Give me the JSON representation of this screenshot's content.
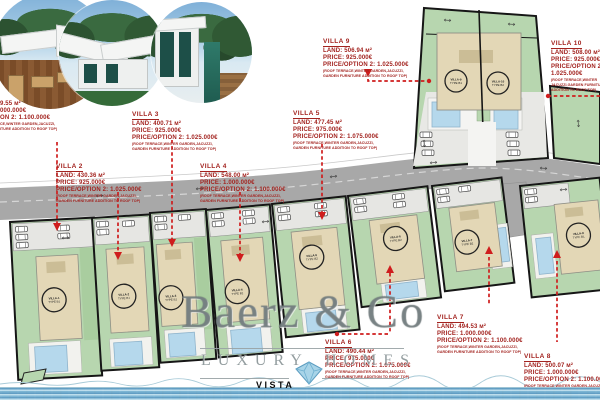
{
  "colors": {
    "annotation_red": "#a32420",
    "leader_red": "#cf1d1d",
    "plot_green": "#b7d6af",
    "building_beige": "#e3d7b6",
    "roof_beige": "#cbbd96",
    "pool_blue": "#b5d8ec",
    "road_gray": "#a8a8a8",
    "water_blue": "#7db8d6"
  },
  "watermark": {
    "brand": "Baerz & Co",
    "word_left": "LUXURY",
    "word_right": "HOMES",
    "footer": "VISTA"
  },
  "plan": {
    "units": [
      {
        "name": "VILLA-1",
        "type": "TYPE B1"
      },
      {
        "name": "VILLA-2",
        "type": "TYPE B1"
      },
      {
        "name": "VILLA-3",
        "type": "TYPE B1"
      },
      {
        "name": "VILLA-4",
        "type": "TYPE B1"
      },
      {
        "name": "VILLA-5",
        "type": "TYPE B2"
      },
      {
        "name": "VILLA-6",
        "type": "TYPE B2"
      },
      {
        "name": "VILLA-7",
        "type": "TYPE B2"
      },
      {
        "name": "VILLA-8",
        "type": "TYPE B1"
      },
      {
        "name": "VILLA-9",
        "type": "TYPE B1"
      },
      {
        "name": "VILLA-10",
        "type": "TYPE B2"
      }
    ]
  },
  "annotations": {
    "villa1": {
      "lines": [
        "9.55 м²",
        "000.000€",
        "ON 2: 1.100.000€"
      ],
      "fine": [
        "CE,WINTER GARDEN,JACUZZI,",
        "ITURE ADDITION TO ROOF TOP)"
      ]
    },
    "villa2": {
      "heading": "VILLA 2",
      "lines": [
        "LAND: 430.36 м²",
        "PRICE: 925.000€",
        "PRICE/OPTION 2: 1.025.000€"
      ],
      "fine": [
        "(ROOF TERRACE,WINTER GARDEN,JACUZZI,",
        "GARDEN FURNITURE ADDITION TO ROOF TOP)"
      ]
    },
    "villa3": {
      "heading": "VILLA 3",
      "lines": [
        "LAND: 400.71 м²",
        "PRICE: 925.000€",
        "PRICE/OPTION 2: 1.025.000€"
      ],
      "fine": [
        "(ROOF TERRACE,WINTER GARDEN,JACUZZI,",
        "GARDEN FURNITURE ADDITION TO ROOF TOP)"
      ]
    },
    "villa4": {
      "heading": "VILLA 4",
      "lines": [
        "LAND: 548.00 м²",
        "PRICE: 1.000.000€",
        "PRICE/OPTION 2: 1.100.000€"
      ],
      "fine": [
        "(ROOF TERRACE,WINTER GARDEN,JACUZZI,",
        "GARDEN FURNITURE ADDITION TO ROOF TOP)"
      ]
    },
    "villa5": {
      "heading": "VILLA 5",
      "lines": [
        "LAND: 477.45 м²",
        "PRICE: 975.000€",
        "PRICE/OPTION 2: 1.075.000€"
      ],
      "fine": [
        "(ROOF TERRACE,WINTER GARDEN,JACUZZI,",
        "GARDEN FURNITURE ADDITION TO ROOF TOP)"
      ]
    },
    "villa6": {
      "heading": "VILLA 6",
      "lines": [
        "LAND: 490.44 м²",
        "PRICE: 975.000€",
        "PRICE/OPTION 2: 1.075.000€"
      ],
      "fine": [
        "(ROOF TERRACE,WINTER GARDEN,JACUZZI,",
        "GARDEN FURNITURE ADDITION TO ROOF TOP)"
      ]
    },
    "villa7": {
      "heading": "VILLA 7",
      "lines": [
        "LAND: 494.53 м²",
        "PRICE: 1.000.000€",
        "PRICE/OPTION 2: 1.100.000€"
      ],
      "fine": [
        "(ROOF TERRACE,WINTER GARDEN,JACUZZI,",
        "GARDEN FURNITURE ADDITION TO ROOF TOP)"
      ]
    },
    "villa8": {
      "heading": "VILLA 8",
      "lines": [
        "LAND: 500.07 м²",
        "PRICE: 1.000.000€",
        "PRICE/OPTION 2: 1.100.000€"
      ],
      "fine": [
        "(ROOF TERRACE,WINTER GARDEN,JACUZZI,",
        "GARDEN FURNITURE ADDITION TO ROOF TOP)"
      ]
    },
    "villa9": {
      "heading": "VILLA 9",
      "lines": [
        "LAND: 506.94 м²",
        "PRICE: 925.000€",
        "PRICE/OPTION 2: 1.025.000€"
      ],
      "fine": [
        "(ROOF TERRACE,WINTER GARDEN,JACUZZI,",
        "GARDEN FURNITURE ADDITION TO ROOF TOP)"
      ]
    },
    "villa10": {
      "heading": "VILLA 10",
      "lines": [
        "LAND: 508.00 м²",
        "PRICE: 925.000€",
        "PRICE/OPTION 2:",
        "1.025.000€"
      ],
      "fine": [
        "(ROOF TERRACE,WINTER",
        "JACUZZI,GARDEN FURNITURE",
        "ADDITION TO ROOF TOP)"
      ]
    }
  }
}
